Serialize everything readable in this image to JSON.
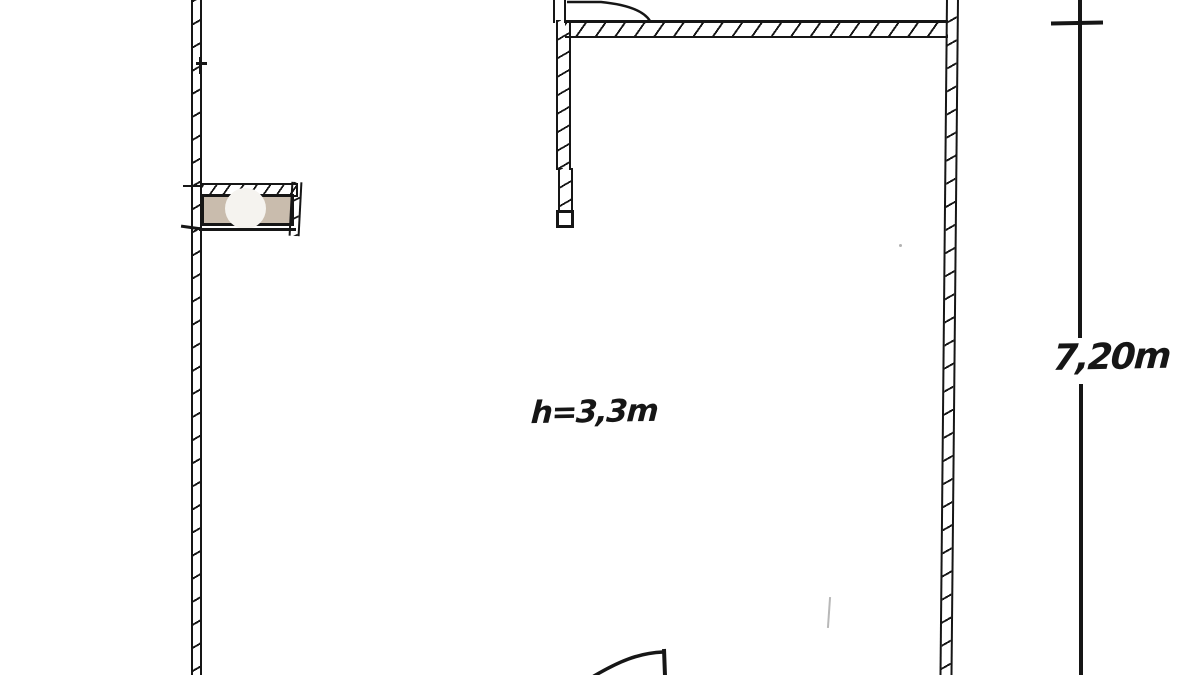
{
  "drawing": {
    "kind": "hand-drawn architectural floor plan",
    "ink_color": "#161616",
    "background_color": "#ffffff",
    "labels": {
      "ceiling_height": "h=3,3m",
      "vertical_dimension": "7,20m"
    },
    "column_fixture": {
      "fill_color": "#c9bcad",
      "circle_color": "#f5f3ef"
    }
  }
}
